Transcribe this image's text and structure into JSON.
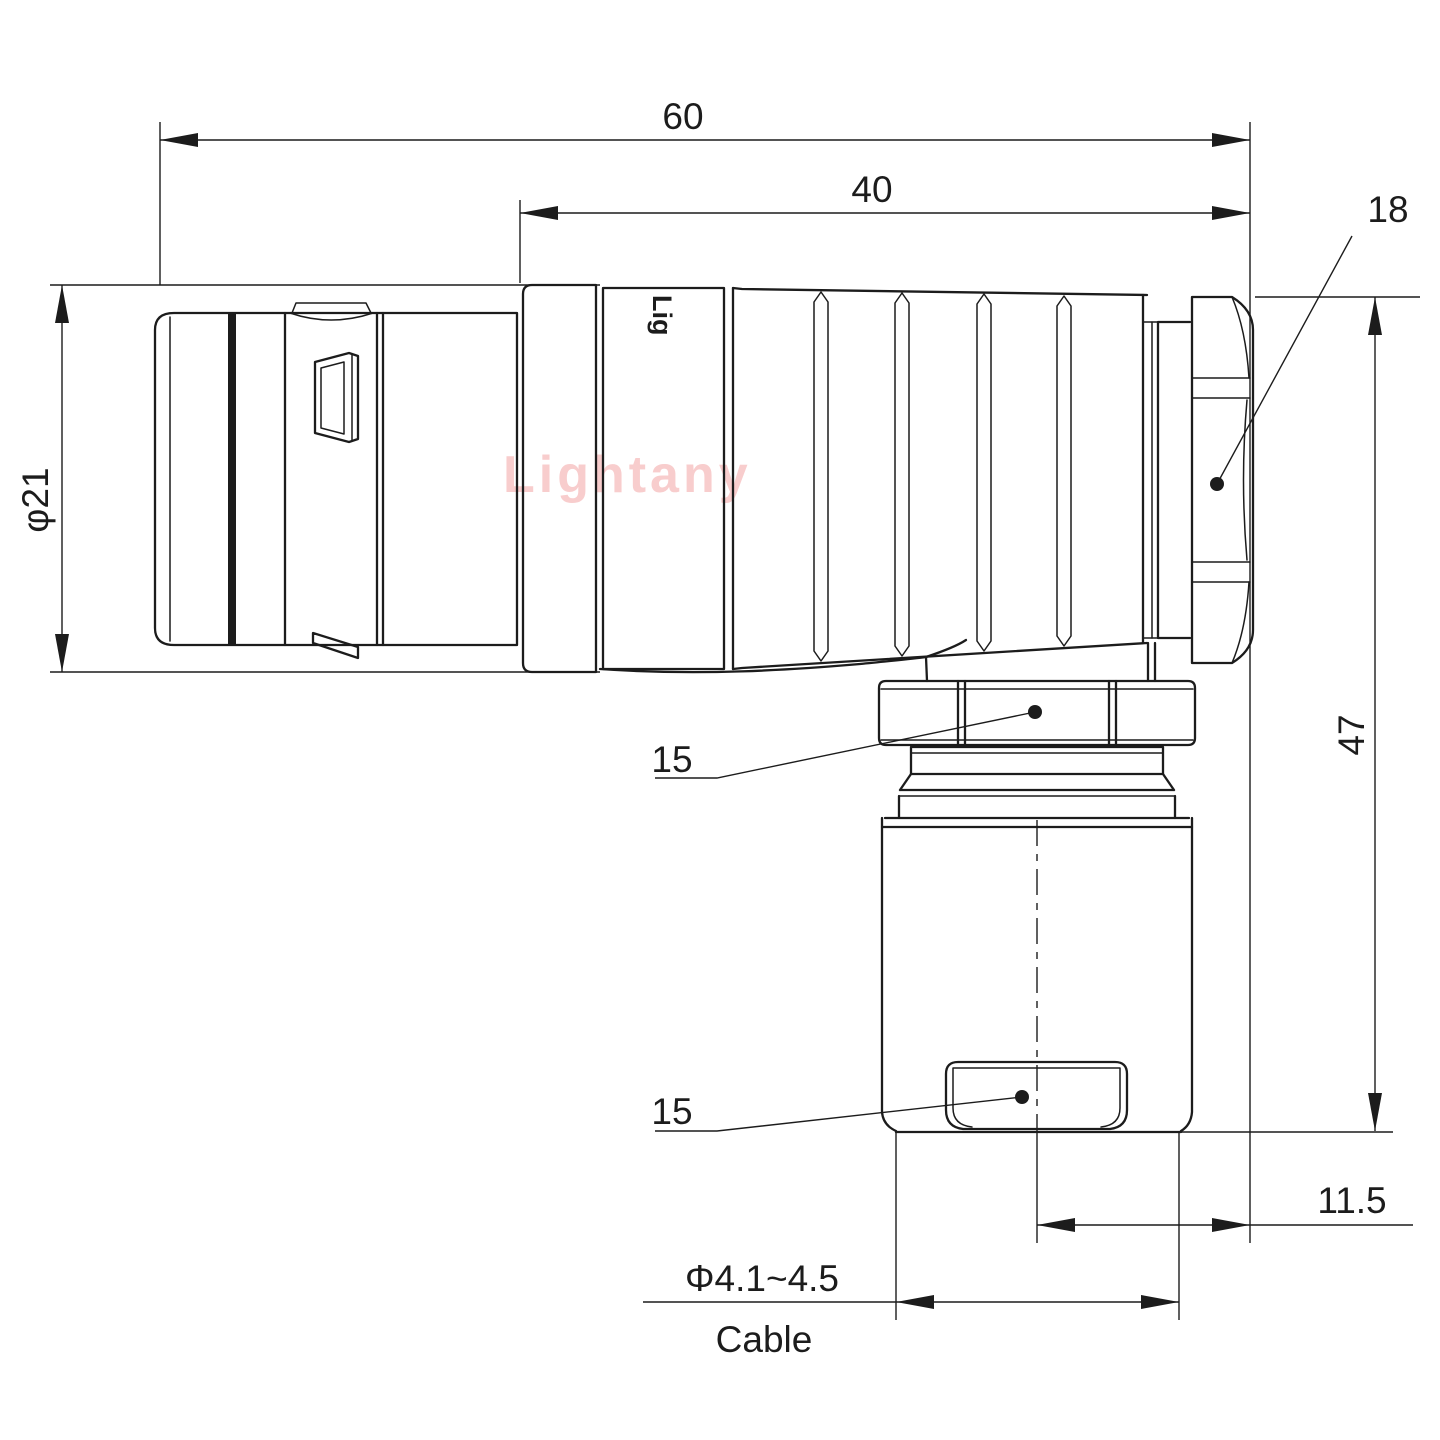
{
  "drawing": {
    "watermark": "Lightany",
    "brand_logo": "Lig",
    "dimensions": {
      "overall_length": "60",
      "rear_length": "40",
      "backshell_nut": "18",
      "plug_diameter": "φ21",
      "total_height": "47",
      "exit_offset": "11.5",
      "elbow_nut_callout": "15",
      "clamp_callout": "15",
      "cable_diameter": "Φ4.1~4.5",
      "cable_label": "Cable"
    },
    "colors": {
      "line": "#1c1c1c",
      "watermark": "#f8cdcd",
      "background": "#ffffff"
    }
  }
}
